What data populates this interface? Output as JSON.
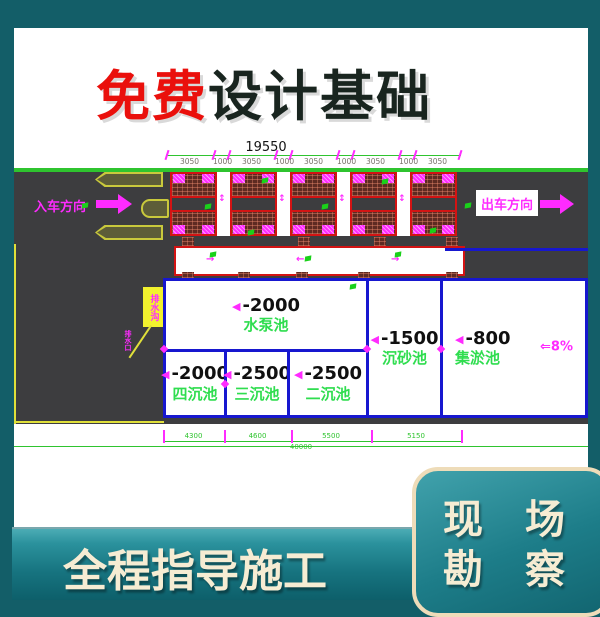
{
  "header": {
    "title_highlight": "免费",
    "title_rest": "设计基础",
    "highlight_color": "#ea100c",
    "text_color": "#19251f"
  },
  "drawing": {
    "top_total": "19550",
    "top_segments": [
      "3050",
      "1000",
      "3050",
      "1000",
      "3050",
      "1000",
      "3050",
      "1000",
      "3050"
    ],
    "entry_label": "入车方向",
    "exit_label": "出车方向",
    "depth_marker": "◀",
    "slope_arrow": "⇐",
    "slope_value": "8%",
    "callout_label": "排水沟",
    "callout_note": "排水口",
    "pools": [
      {
        "name": "水泵池",
        "depth": "-2000"
      },
      {
        "name": "四沉池",
        "depth": "-2000"
      },
      {
        "name": "三沉池",
        "depth": "-2500"
      },
      {
        "name": "二沉池",
        "depth": "-2500"
      },
      {
        "name": "沉砂池",
        "depth": "-1500"
      },
      {
        "name": "集淤池",
        "depth": "-800"
      }
    ],
    "bottom_segments": [
      "4300",
      "4600",
      "5500",
      "5150"
    ],
    "bottom_total": "40000",
    "colors": {
      "road": "#3d3d3f",
      "lane_green": "#2fc42f",
      "bay_red": "#d31313",
      "hatch_fill": "#5e2a22",
      "magenta": "#ff2bff",
      "pool_border": "#1717cf",
      "pool_name_green": "#2fdd4f",
      "island_yellow": "#c9c93c"
    }
  },
  "footer": {
    "band_label": "全程指导施工",
    "badge_line1": "现 场",
    "badge_line2": "勘 察",
    "text_color": "#f6ecd3"
  }
}
